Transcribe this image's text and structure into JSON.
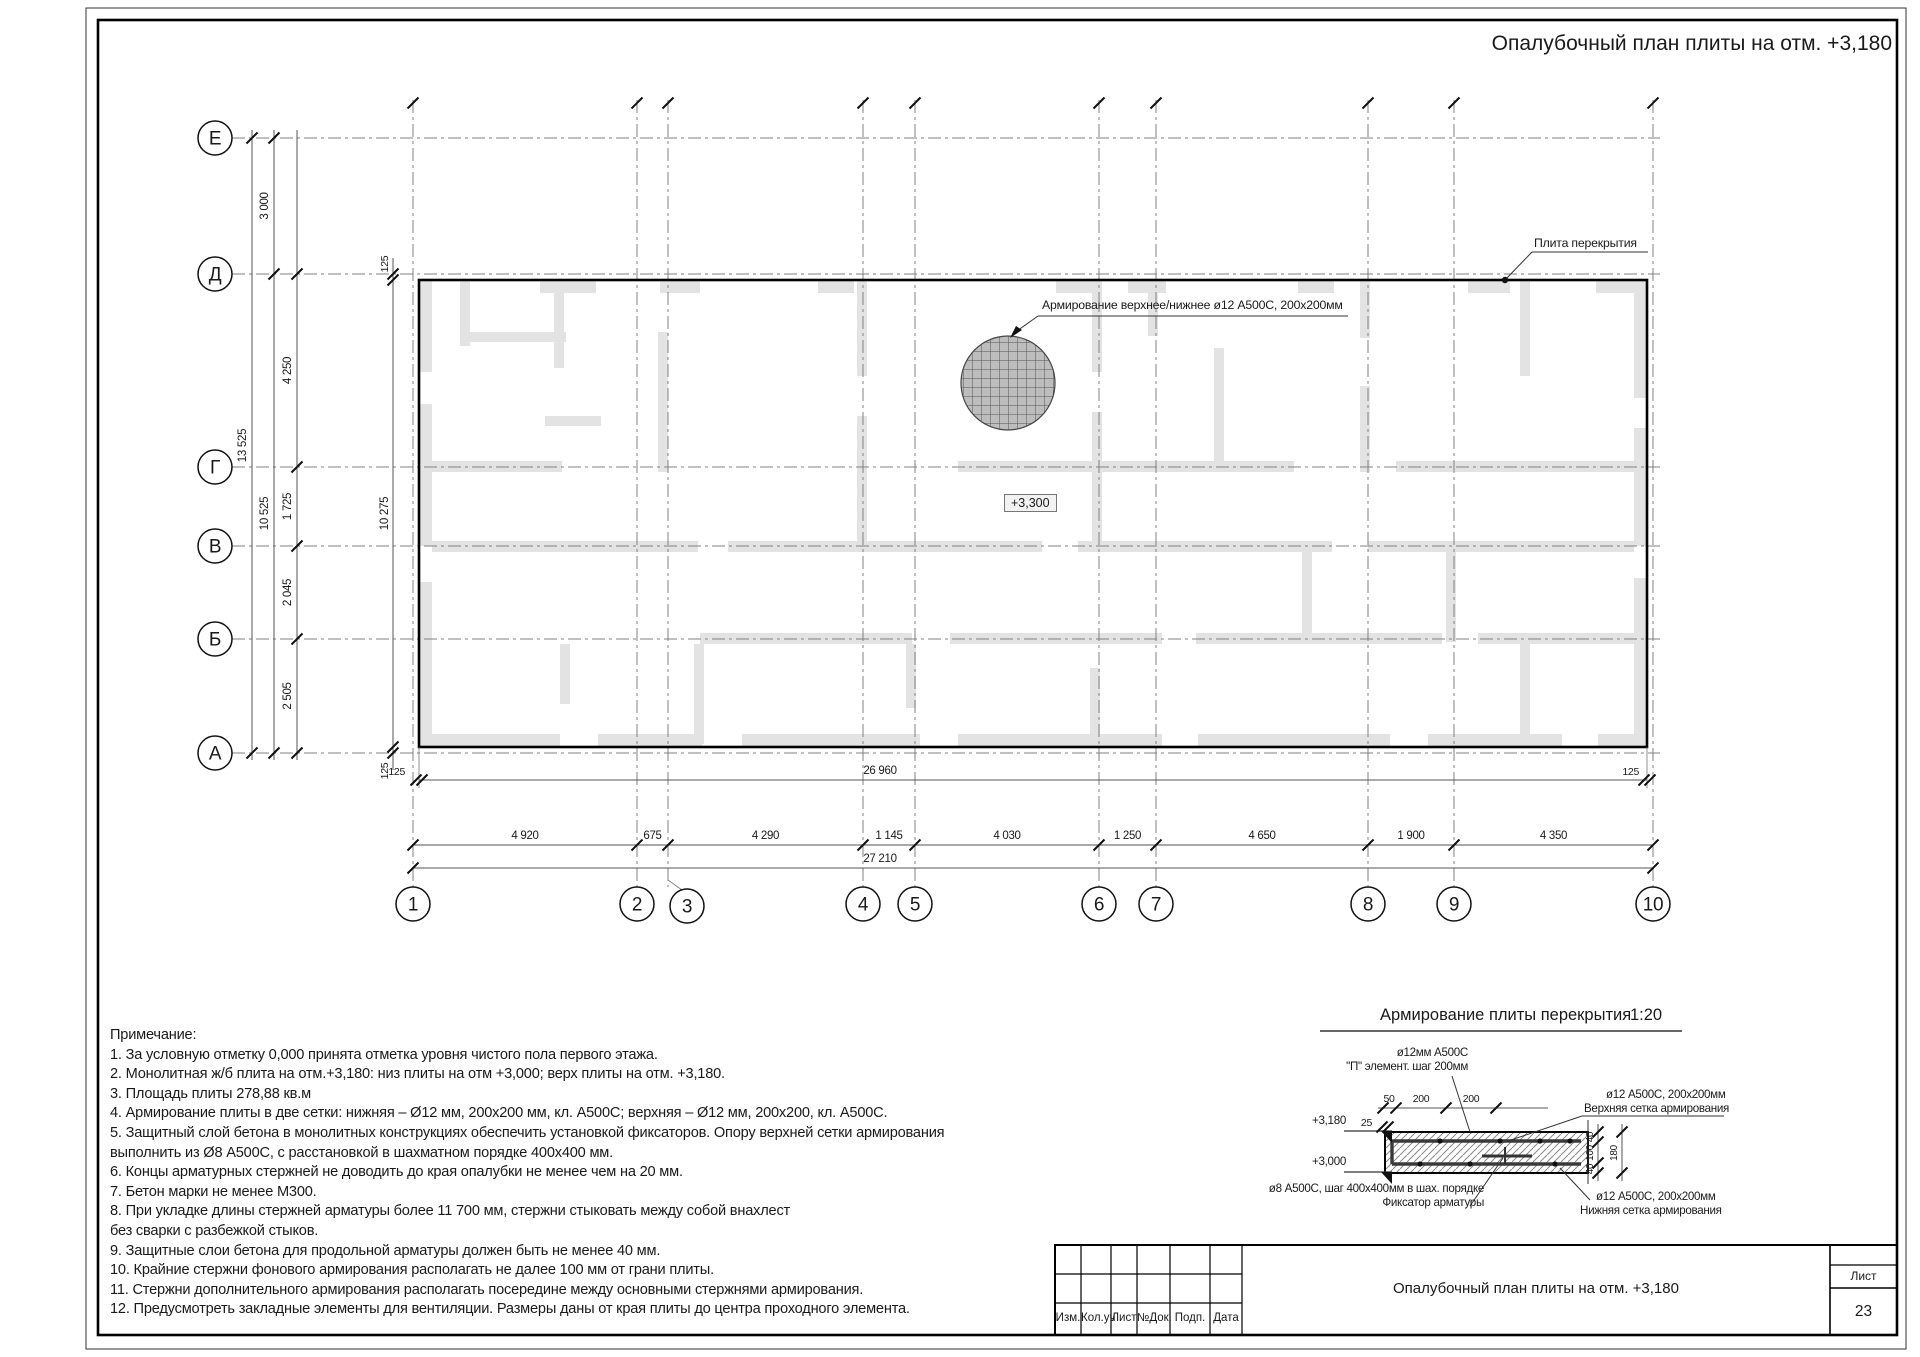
{
  "sheet": {
    "title": "Опалубочный план плиты на отм. +3,180"
  },
  "plan": {
    "column_axes": [
      "1",
      "2",
      "3",
      "4",
      "5",
      "6",
      "7",
      "8",
      "9",
      "10"
    ],
    "row_axes": [
      "Е",
      "Д",
      "Г",
      "В",
      "Б",
      "А"
    ],
    "bottom_spans": [
      "4 920",
      "675",
      "4 290",
      "1 145",
      "4 030",
      "1 250",
      "4 650",
      "1 900",
      "4 350"
    ],
    "bottom_total_inner": "26 960",
    "bottom_total": "27 210",
    "left_top_span": "3 000",
    "left_spans": [
      "4 250",
      "1 725",
      "2 045",
      "2 505"
    ],
    "left_total": "13 525",
    "left_subtotal": "10 525",
    "slab_height": "10 275",
    "edge_offset": "125",
    "slab_label": "Плита перекрытия",
    "reinforcement_note": "Армирование верхнее/нижнее ø12 А500С, 200х200мм",
    "elevation_mark": "+3,300"
  },
  "detail": {
    "title": "Армирование плиты перекрытия",
    "scale": "1:20",
    "top_left_label_1": "ø12мм А500С",
    "top_left_label_2": "\"П\" элемент.  шаг 200мм",
    "top_dims": [
      "50",
      "200",
      "200"
    ],
    "offset_dim": "25",
    "elev_top": "+3,180",
    "elev_bottom": "+3,000",
    "right_top_label_1": "ø12 А500С, 200х200мм",
    "right_top_label_2": "Верхняя сетка армирования",
    "side_dims": [
      "40",
      "100",
      "40"
    ],
    "side_total": "180",
    "bottom_left_label_1": "ø8 А500С, шаг 400х400мм в шах. порядке",
    "bottom_left_label_2": "Фиксатор арматуры",
    "bottom_right_label_1": "ø12 А500С, 200х200мм",
    "bottom_right_label_2": "Нижняя сетка армирования"
  },
  "notes": {
    "heading": "Примечание:",
    "lines": [
      "1. За условную отметку 0,000 принята отметка уровня чистого пола первого этажа.",
      "2. Монолитная ж/б плита  на отм.+3,180: низ плиты на отм +3,000; верх плиты на отм. +3,180.",
      "3. Площадь плиты 278,88 кв.м",
      "4. Армирование плиты в две сетки: нижняя – Ø12 мм, 200х200 мм, кл. А500С; верхняя – Ø12 мм, 200х200, кл. А500С.",
      "5. Защитный слой бетона в монолитных конструкциях обеспечить установкой фиксаторов. Опору верхней сетки армирования",
      "выполнить из Ø8 А500С, с расстановкой в шахматном порядке 400х400 мм.",
      "6. Концы арматурных стержней не доводить до края опалубки не менее чем на 20 мм.",
      "7. Бетон марки не менее М300.",
      "8. При укладке длины стержней арматуры более 11 700 мм, стержни стыковать между собой внахлест",
      "без сварки с разбежкой стыков.",
      "9. Защитные слои бетона для продольной арматуры должен быть не менее 40 мм.",
      "10. Крайние стержни фонового армирования располагать не далее 100 мм от грани плиты.",
      "11. Стержни дополнительного армирования располагать посередине между основными стержнями армирования.",
      "12. Предусмотреть закладные элементы для вентиляции. Размеры даны от края плиты до центра проходного элемента."
    ]
  },
  "titleblock": {
    "doc_title": "Опалубочный план плиты на отм. +3,180",
    "columns": [
      "Изм.",
      "Кол.уч",
      "Лист",
      "№Док.",
      "Подп.",
      "Дата"
    ],
    "sheet_label": "Лист",
    "sheet_number": "23"
  },
  "colors": {
    "line": "#1a1a1a",
    "axis": "#808080",
    "wall": "#e3e3e3",
    "hatch_fill": "#bdbdbd"
  }
}
